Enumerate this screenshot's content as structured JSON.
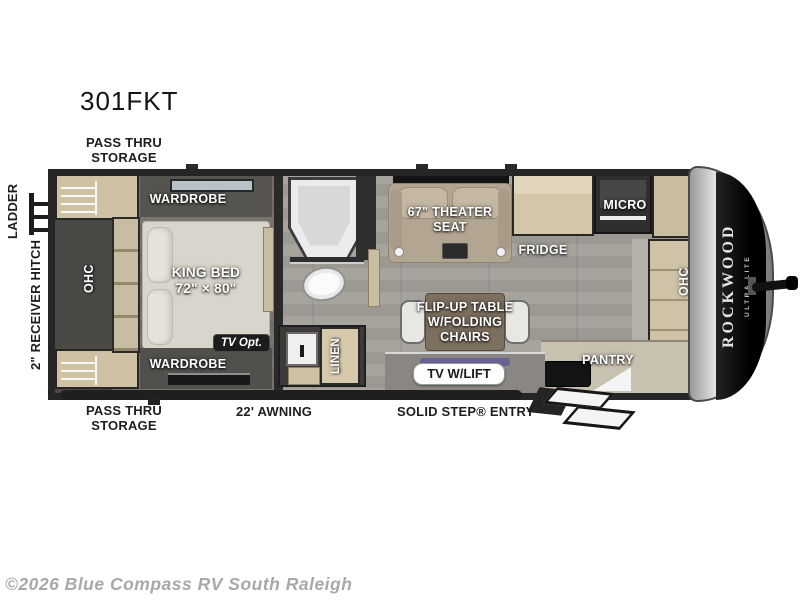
{
  "title": "301FKT",
  "watermark": "©2026 Blue Compass RV South Raleigh",
  "exterior_labels": {
    "pass_thru_storage_top": "PASS THRU STORAGE",
    "pass_thru_storage_bottom": "PASS THRU STORAGE",
    "ladder": "LADDER",
    "receiver_hitch": "2\" RECEIVER HITCH",
    "awning": "22' AWNING",
    "entry": "SOLID STEP® ENTRY"
  },
  "interior_labels": {
    "wardrobe_top": "WARDROBE",
    "wardrobe_bottom": "WARDROBE",
    "king_bed": "KING BED",
    "king_bed_size": "72\" × 80\"",
    "ohc_bedroom": "OHC",
    "tv_opt": "TV Opt.",
    "linen": "LINEN",
    "theater_seat_line1": "67\" THEATER",
    "theater_seat_line2": "SEAT",
    "fridge": "FRIDGE",
    "micro": "MICRO",
    "flip_table_line1": "FLIP-UP TABLE",
    "flip_table_line2": "W/FOLDING",
    "flip_table_line3": "CHAIRS",
    "tv_w_lift": "TV W/LIFT",
    "pantry": "PANTRY",
    "ohc_front": "OHC"
  },
  "brand": {
    "name": "ROCKWOOD",
    "sub": "ULTRA LITE"
  },
  "colors": {
    "wall": "#262626",
    "floor": "#a19e98",
    "bedroom_floor": "#75726c",
    "cabinet_wood": "#cfc2a4",
    "bed": "#d9d5cc",
    "theater_seat": "#b2a692",
    "front_cap_silver": "#d9d9d9",
    "front_cap_black": "#0a0a0a",
    "label_text": "#ffffff",
    "exterior_text": "#1e1e1e",
    "watermark_text": "#a8a8a8"
  }
}
